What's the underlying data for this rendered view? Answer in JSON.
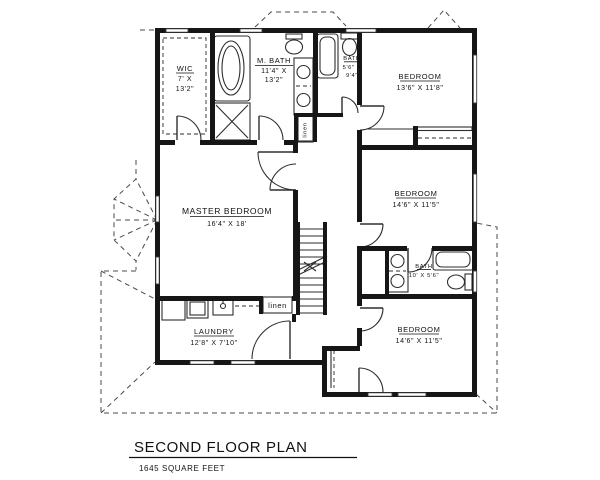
{
  "colors": {
    "wall": "#161616",
    "line": "#2e2e2e",
    "dash": "#4a4a4a",
    "background": "#ffffff"
  },
  "title": {
    "heading": "SECOND FLOOR PLAN",
    "area_label": "1645 SQUARE FEET"
  },
  "rooms": {
    "wic": {
      "name": "WIC",
      "dim1": "7' X",
      "dim2": "13'2\""
    },
    "master_bath": {
      "name": "M. BATH",
      "dim1": "11'4\" X",
      "dim2": "13'2\""
    },
    "hall_bath": {
      "name": "BATH",
      "dim1": "5'6\" X",
      "dim2": "9'4\""
    },
    "bedroom_top": {
      "name": "BEDROOM",
      "dims": "13'6\" X 11'8\""
    },
    "bedroom_mid": {
      "name": "BEDROOM",
      "dims": "14'6\" X 11'5\""
    },
    "bath_jack": {
      "name": "BATH",
      "dims": "10' X 5'6\""
    },
    "bedroom_bottom": {
      "name": "BEDROOM",
      "dims": "14'6\" X 11'5\""
    },
    "master_bedroom": {
      "name": "MASTER BEDROOM",
      "dims": "16'4\" X 18'"
    },
    "laundry": {
      "name": "LAUNDRY",
      "dims": "12'8\" X 7'10\""
    },
    "linen_upper": {
      "label": "linen"
    },
    "linen_lower": {
      "label": "linen"
    }
  }
}
